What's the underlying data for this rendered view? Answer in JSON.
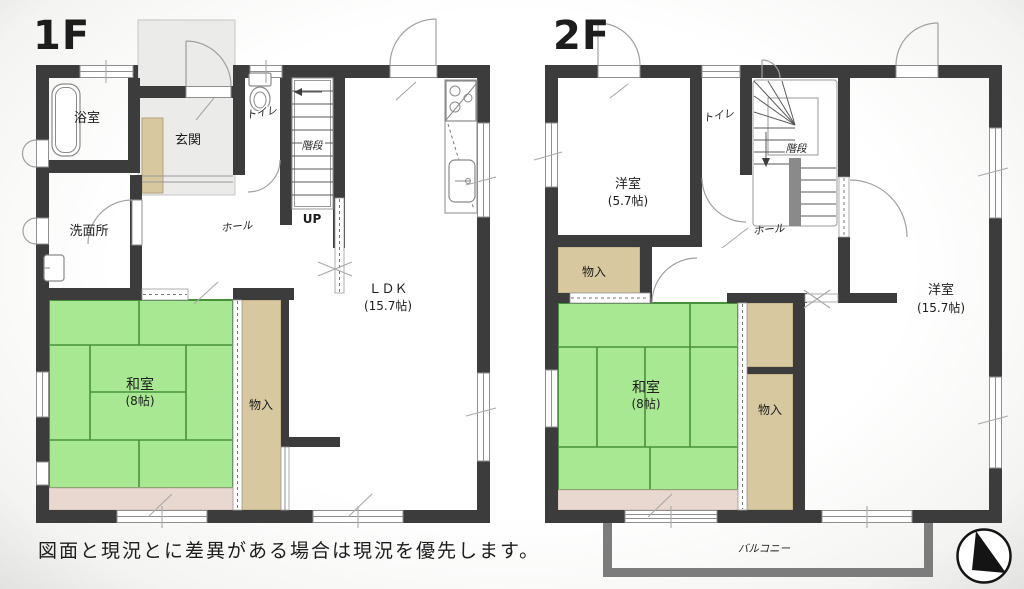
{
  "floor1": {
    "title": "1F",
    "rooms": {
      "bath": "浴室",
      "entrance": "玄関",
      "toilet": "トイレ",
      "stairs": "階段",
      "up": "UP",
      "washroom": "洗面所",
      "hall": "ホール",
      "ldk": "ＬＤＫ",
      "ldk_size": "(15.7帖)",
      "washitsu": "和室",
      "washitsu_size": "(8帖)",
      "closet": "物入"
    }
  },
  "floor2": {
    "title": "2F",
    "rooms": {
      "western_small": "洋室",
      "western_small_size": "(5.7帖)",
      "toilet": "トイレ",
      "stairs": "階段",
      "hall": "ホール",
      "closet_upper": "物入",
      "washitsu": "和室",
      "washitsu_size": "(8帖)",
      "closet_side": "物入",
      "western_large": "洋室",
      "western_large_size": "(15.7帖)",
      "balcony": "バルコニー"
    }
  },
  "footer": {
    "disclaimer": "図面と現況とに差異がある場合は現況を優先します。"
  },
  "icons": {
    "compass": "north-arrow"
  },
  "colors": {
    "wall": "#3c3c3c",
    "tatami": "#a8e892",
    "tatami_line": "#47913b",
    "closet": "#d7c8a0",
    "veranda": "#e9d8cf",
    "porch": "#ebebea",
    "stair_rail": "#8a8a8a",
    "balcony_wall": "#7c7c7c"
  }
}
